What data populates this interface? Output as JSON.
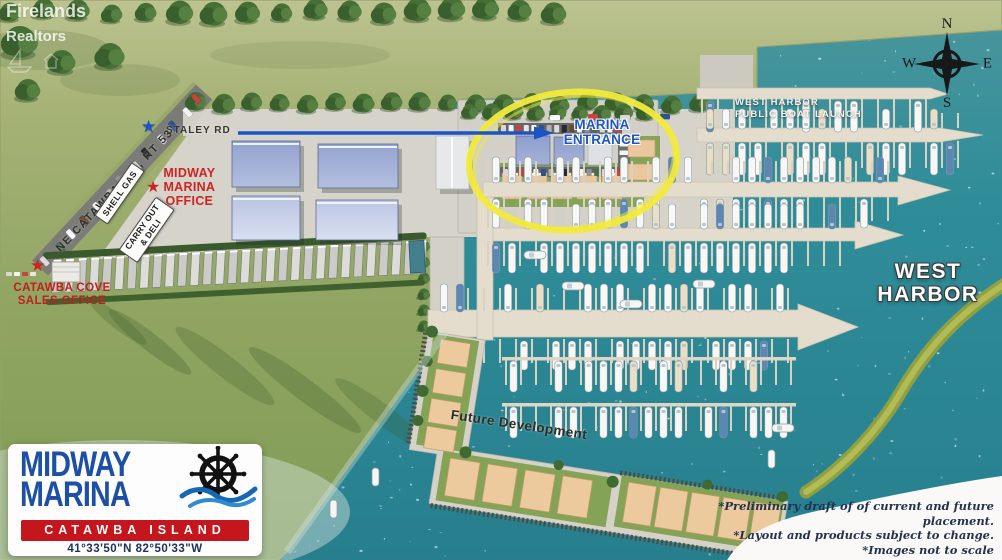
{
  "watermark": {
    "name": "Firelands",
    "type": "Realtors"
  },
  "compass": {
    "north": "N",
    "east": "E",
    "south": "S",
    "west": "W"
  },
  "map_labels": {
    "boat_launch": {
      "line1": "WEST HARBOR",
      "line2": "PUBLIC BOAT LAUNCH"
    },
    "staley_road": "STALEY RD",
    "marina_entrance": {
      "line1": "MARINA",
      "line2": "ENTRANCE"
    },
    "catawba_road": "NE CATAWBA RD., RT 53",
    "shell_gas_sign": "SHELL GAS",
    "carry_out_sign": {
      "line1": "CARRY OUT",
      "line2": "& DELI"
    },
    "marina_office": {
      "line1": "MIDWAY",
      "line2": "MARINA",
      "line3": "OFFICE"
    },
    "sales_office": {
      "line1": "CATAWBA COVE",
      "line2": "SALES OFFICE"
    },
    "west_harbor": {
      "line1": "WEST",
      "line2": "HARBOR"
    },
    "future_development": "Future Development"
  },
  "logo": {
    "line1": "MIDWAY",
    "line2": "MARINA",
    "banner": "CATAWBA ISLAND",
    "coordinates": "41°33'50\"N  82°50'33\"W"
  },
  "disclaimers": {
    "line1": "*Preliminary draft of of current and future placement.",
    "line2": "*Layout and products subject to change.",
    "line3": "*Images not to scale"
  },
  "colors": {
    "water": "#2e8b97",
    "grass": "#9db06c",
    "highlight_circle": "#f2ea3c",
    "accent_red": "#cf2421",
    "accent_blue": "#1d55c8",
    "logo_blue": "#1c4fa5",
    "banner_red": "#c4161c"
  }
}
